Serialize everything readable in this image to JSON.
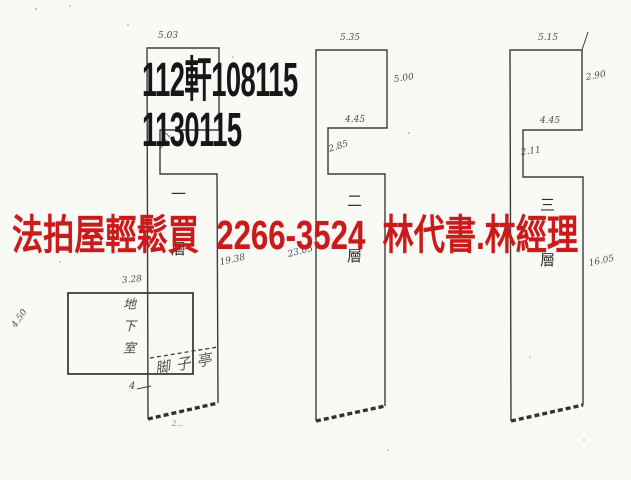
{
  "overlay": {
    "case_number_line1": "112軒108115",
    "case_number_line2": "1130115",
    "case_number_color": "#171717",
    "ad_text": "法拍屋輕鬆買  2266-3524  林代書.林經理",
    "ad_color": "#c91b1b"
  },
  "plans": [
    {
      "floor_label": "一層",
      "porch_label": "脚子亭",
      "dims": {
        "top": "5.03",
        "notch_height": "2.11",
        "right": "19.38",
        "left_tick": "4",
        "bottom_mark": "2..."
      }
    },
    {
      "floor_label": "二層",
      "dims": {
        "top": "5.35",
        "right_upper": "5.00",
        "notch_width": "4.45",
        "notch_height": "2.85",
        "left": "23.05"
      }
    },
    {
      "floor_label": "三層",
      "dims": {
        "top": "5.15",
        "right_upper": "2.90",
        "notch_width": "4.45",
        "notch_height": "2.11",
        "right_lower": "16.05"
      }
    }
  ],
  "basement": {
    "label": "地下室",
    "dims": {
      "top": "3.28",
      "left": "4.50"
    }
  }
}
